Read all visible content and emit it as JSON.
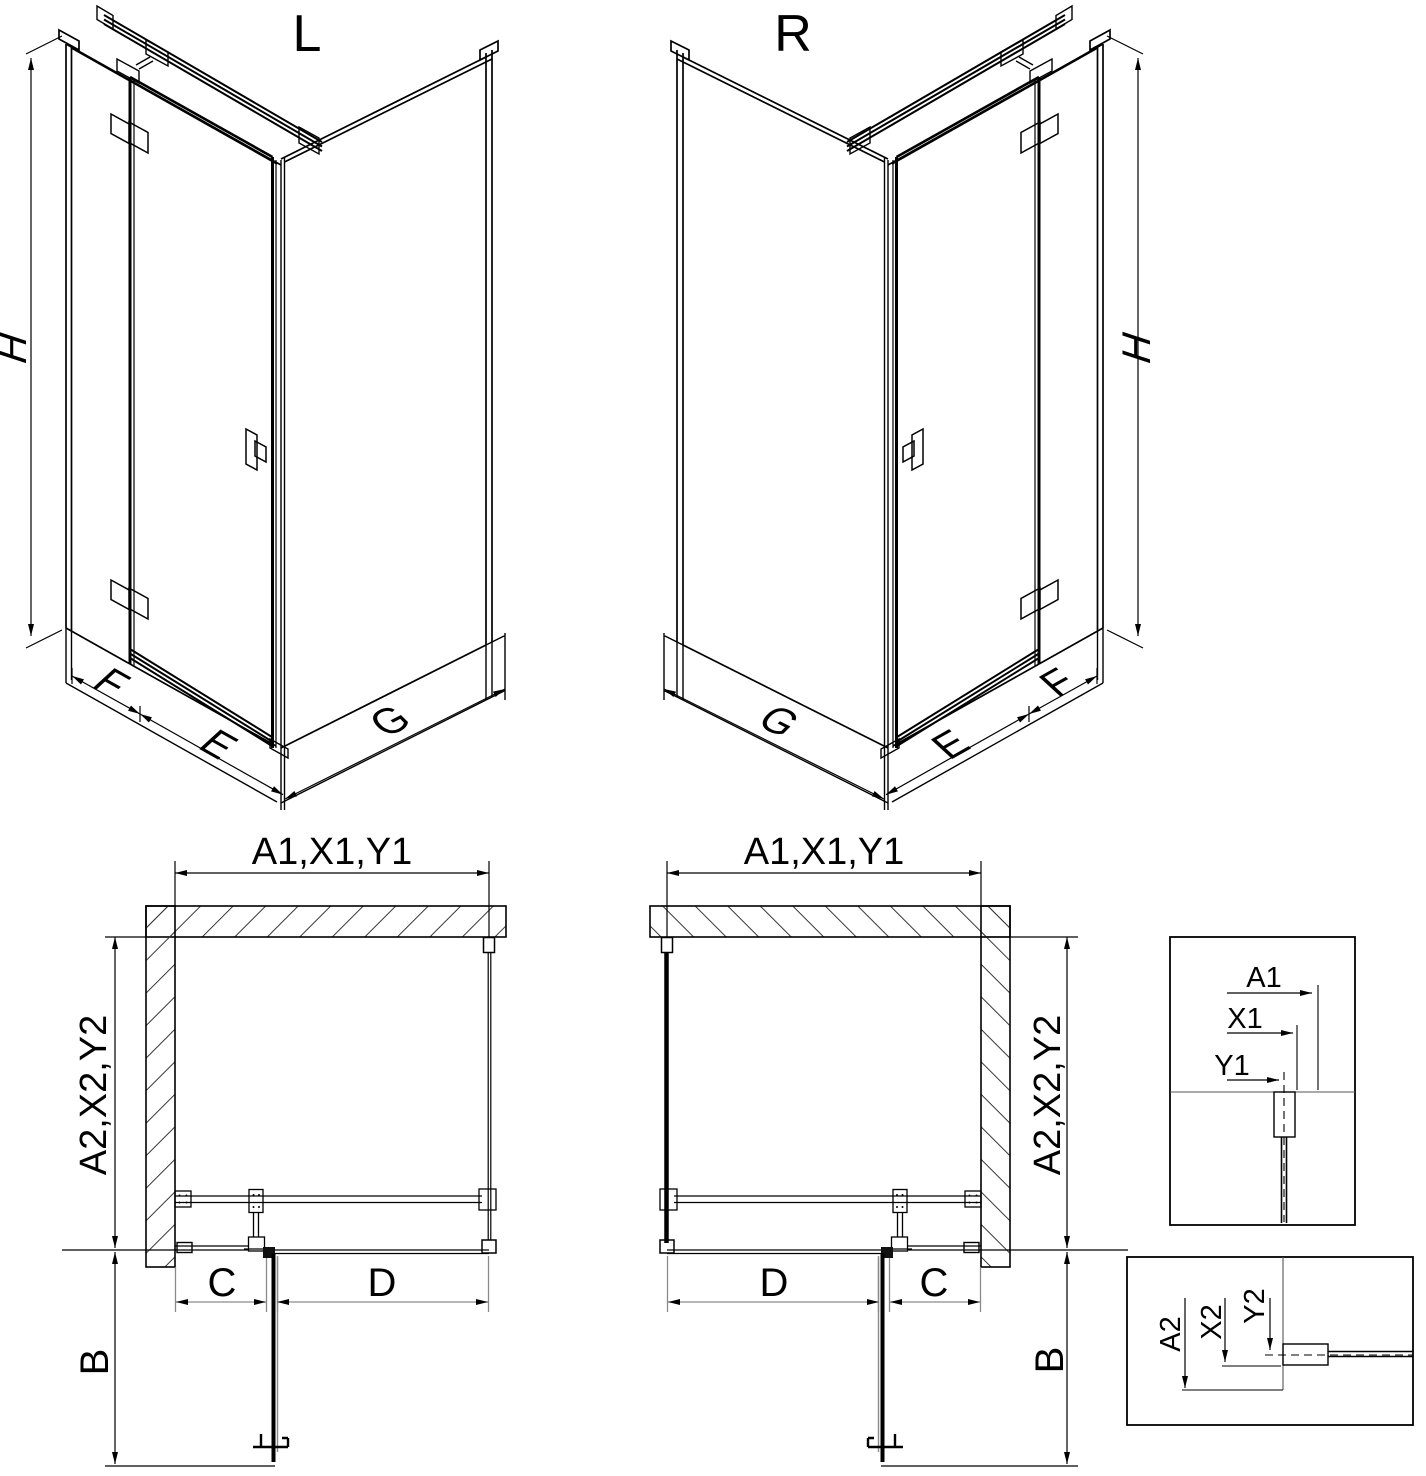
{
  "colors": {
    "line": "#000000",
    "dim_secondary": "#8a8a8a"
  },
  "iso_left": {
    "title": "L",
    "height": "H",
    "panel_return": "F",
    "door_width": "E",
    "side_width": "G"
  },
  "iso_right": {
    "title": "R",
    "height": "H",
    "panel_return": "F",
    "door_width": "E",
    "side_width": "G"
  },
  "plan_left": {
    "width_top": "A1,X1,Y1",
    "depth_side": "A2,X2,Y2",
    "wall_to_door": "C",
    "door_width": "D",
    "door_swing": "B"
  },
  "plan_right": {
    "width_top": "A1,X1,Y1",
    "depth_side": "A2,X2,Y2",
    "wall_to_door": "C",
    "door_width": "D",
    "door_swing": "B"
  },
  "detail_width": {
    "a": "A1",
    "x": "X1",
    "y": "Y1"
  },
  "detail_depth": {
    "a": "A2",
    "x": "X2",
    "y": "Y2"
  }
}
